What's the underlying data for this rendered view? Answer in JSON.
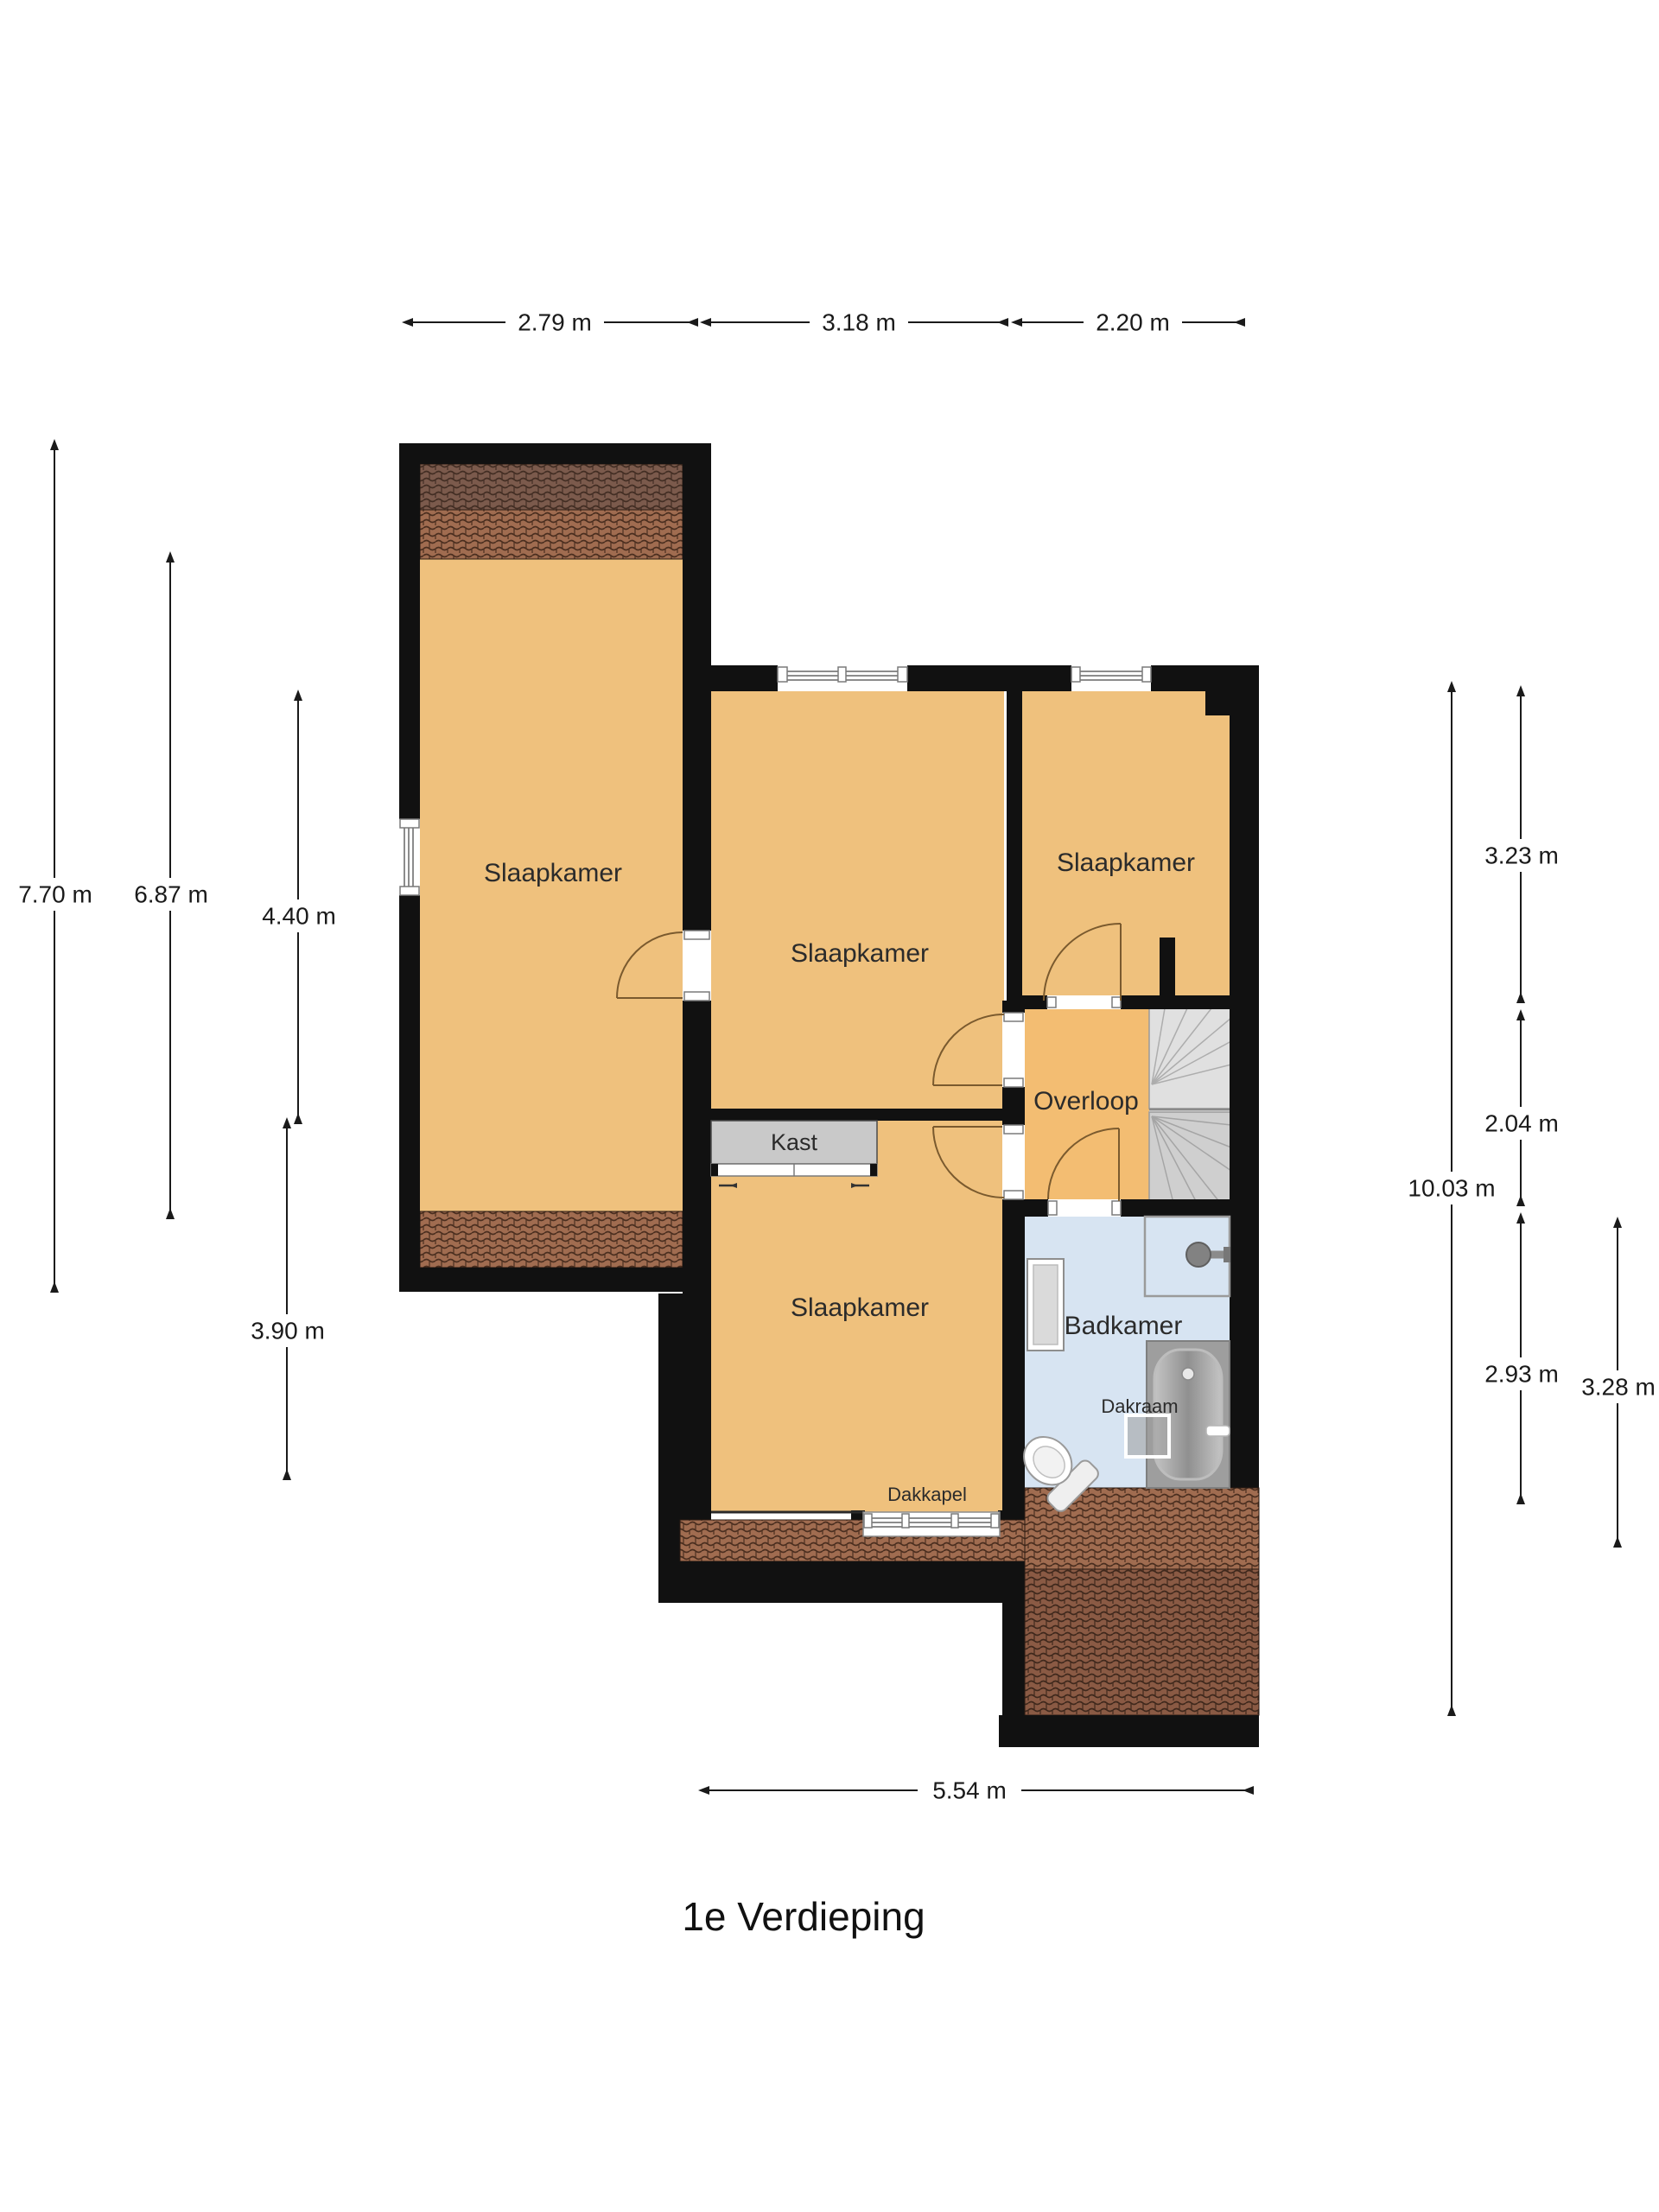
{
  "floor_title": "1e Verdieping",
  "rooms": {
    "bedroom_left": "Slaapkamer",
    "bedroom_middle": "Slaapkamer",
    "bedroom_right": "Slaapkamer",
    "bedroom_bottom": "Slaapkamer",
    "landing": "Overloop",
    "bathroom": "Badkamer",
    "closet": "Kast"
  },
  "features": {
    "dormer": "Dakkapel",
    "roof_window": "Dakraam"
  },
  "dimensions": {
    "top": [
      "2.79 m",
      "3.18 m",
      "2.20 m"
    ],
    "left": [
      "7.70 m",
      "6.87 m",
      "4.40 m",
      "3.90 m"
    ],
    "right": [
      "3.23 m",
      "2.04 m",
      "2.93 m",
      "3.28 m"
    ],
    "right_total": "10.03 m",
    "bottom": "5.54 m"
  },
  "colors": {
    "wall": "#111111",
    "floor_orange": "#efc17d",
    "bathroom_blue": "#d7e4f2",
    "roof_dark": "#7b5a4c",
    "roof_light": "#a06c50",
    "roof_mid": "#8a5a44",
    "closet_gray": "#c9c9c9",
    "stairs_light": "#e0e0e0",
    "stairs_dark": "#cfcfcf"
  }
}
